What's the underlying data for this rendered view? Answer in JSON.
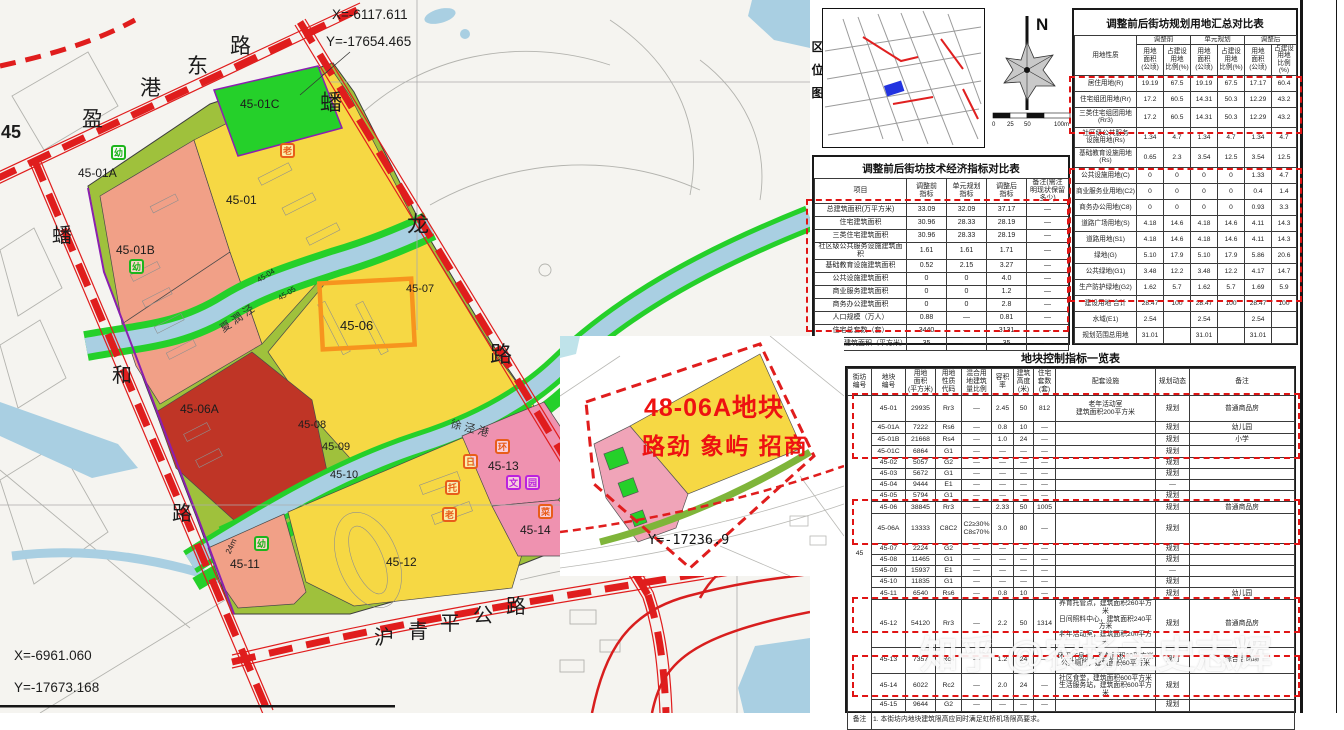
{
  "map": {
    "block_edge_label": "45",
    "coords": {
      "top_x": "X=-6117.611",
      "top_y": "Y=-17654.465",
      "bottom_x": "X=-6961.060",
      "bottom_y": "Y=-17673.168",
      "right_y": "Y=-17236.9"
    },
    "roads": {
      "yinggang": "盈港东路",
      "panhe": "蟠和路",
      "panlong": "蟠龙路",
      "huqingping": "沪青平公路"
    },
    "rivers": {
      "xiarun": "夏潤泾",
      "xujing": "徐泾港"
    },
    "width_label": "24m",
    "parcel_labels": {
      "p45_01": "45-01",
      "p45_01a": "45-01A",
      "p45_01b": "45-01B",
      "p45_01c": "45-01C",
      "p45_04": "45-04",
      "p45_05": "45-05",
      "p45_06": "45-06",
      "p45_06a": "45-06A",
      "p45_07": "45-07",
      "p45_08": "45-08",
      "p45_09": "45-09",
      "p45_10": "45-10",
      "p45_11": "45-11",
      "p45_12": "45-12",
      "p45_13": "45-13",
      "p45_14": "45-14"
    },
    "facility_icons": {
      "kindergarten": "幼",
      "elder": "老",
      "care": "托",
      "day": "日",
      "culture": "文",
      "garden": "园",
      "market": "菜",
      "sanitation": "环"
    },
    "colors": {
      "residential_yellow": "#f6d844",
      "salmon": "#f1a087",
      "dark_red": "#bf3526",
      "pink": "#ef92b0",
      "green": "#25d02a",
      "olive": "#9fc13c",
      "river_blue": "#a9cfe2",
      "road_red": "#e01d1d",
      "highlight_orange": "#f7941e"
    }
  },
  "inset": {
    "line1": "48-06A地块",
    "line2": "路劲 象屿 招商"
  },
  "location_map": {
    "title": "区位图"
  },
  "compass": {
    "north": "N",
    "scale_labels": [
      "0",
      "25",
      "50",
      "100m"
    ]
  },
  "side_label": "一般地区",
  "watermark": "知乎 @农场主史志辉",
  "tables": {
    "landuse": {
      "title": "调整前后街坊规划用地汇总对比表",
      "header_rows": [
        [
          {
            "t": "用地性质",
            "rs": 2
          },
          {
            "t": "调整前",
            "cs": 2
          },
          {
            "t": "单元规划",
            "cs": 2
          },
          {
            "t": "调整后",
            "cs": 2
          }
        ],
        [
          "用地\n面积\n(公顷)",
          "占建设\n用地\n比例(%)",
          "用地\n面积\n(公顷)",
          "占建设\n用地\n比例(%)",
          "用地\n面积\n(公顷)",
          "占建设\n用地\n比例(%)"
        ]
      ],
      "rows": [
        [
          "居住用地(R)",
          "19.19",
          "67.5",
          "19.19",
          "67.5",
          "17.17",
          "60.4"
        ],
        [
          "住宅组团用地(Rr)",
          "17.2",
          "60.5",
          "14.31",
          "50.3",
          "12.29",
          "43.2"
        ],
        [
          "三类住宅组团用地\n(Rr3)",
          "17.2",
          "60.5",
          "14.31",
          "50.3",
          "12.29",
          "43.2"
        ],
        [
          "社区级公共服务\n设施用地(Rs)",
          "1.34",
          "4.7",
          "1.34",
          "4.7",
          "1.34",
          "4.7"
        ],
        [
          "基础教育设施用地\n(Rs)",
          "0.65",
          "2.3",
          "3.54",
          "12.5",
          "3.54",
          "12.5"
        ],
        [
          "公共设施用地(C)",
          "0",
          "0",
          "0",
          "0",
          "1.33",
          "4.7"
        ],
        [
          "商业服务业用地(C2)",
          "0",
          "0",
          "0",
          "0",
          "0.4",
          "1.4"
        ],
        [
          "商务办公用地(C8)",
          "0",
          "0",
          "0",
          "0",
          "0.93",
          "3.3"
        ],
        [
          "道路广场用地(S)",
          "4.18",
          "14.6",
          "4.18",
          "14.6",
          "4.11",
          "14.3"
        ],
        [
          "道路用地(S1)",
          "4.18",
          "14.6",
          "4.18",
          "14.6",
          "4.11",
          "14.3"
        ],
        [
          "绿地(G)",
          "5.10",
          "17.9",
          "5.10",
          "17.9",
          "5.86",
          "20.6"
        ],
        [
          "公共绿地(G1)",
          "3.48",
          "12.2",
          "3.48",
          "12.2",
          "4.17",
          "14.7"
        ],
        [
          "生产防护绿地(G2)",
          "1.62",
          "5.7",
          "1.62",
          "5.7",
          "1.69",
          "5.9"
        ],
        [
          "建设用地  合计",
          "28.47",
          "100",
          "28.47",
          "100",
          "28.47",
          "100"
        ],
        [
          "水域(E1)",
          "2.54",
          "",
          "2.54",
          "",
          "2.54",
          ""
        ],
        [
          "规划范围总用地",
          "31.01",
          "",
          "31.01",
          "",
          "31.01",
          ""
        ]
      ]
    },
    "tech": {
      "title": "调整前后街坊技术经济指标对比表",
      "header_rows": [
        [
          "项目",
          "调整前\n指标",
          "单元规划\n指标",
          "调整后\n指标",
          "备注(需注\n明现状保留\n多少)"
        ]
      ],
      "rows": [
        [
          "总建筑面积(万平方米)",
          "33.09",
          "32.09",
          "37.17",
          "—"
        ],
        [
          "住宅建筑面积",
          "30.96",
          "28.33",
          "28.19",
          "—"
        ],
        [
          "三类住宅建筑面积",
          "30.96",
          "28.33",
          "28.19",
          "—"
        ],
        [
          "社区级公共服务设施建筑面积",
          "1.61",
          "1.61",
          "1.71",
          "—"
        ],
        [
          "基础教育设施建筑面积",
          "0.52",
          "2.15",
          "3.27",
          "—"
        ],
        [
          "公共设施建筑面积",
          "0",
          "0",
          "4.0",
          "—"
        ],
        [
          "商业服务建筑面积",
          "0",
          "0",
          "1.2",
          "—"
        ],
        [
          "商务办公建筑面积",
          "0",
          "0",
          "2.8",
          "—"
        ],
        [
          "人口规模（万人）",
          "0.88",
          "—",
          "0.81",
          "—"
        ],
        [
          "住宅总套数（套）",
          "3440",
          "—",
          "3131",
          "—"
        ],
        [
          "人均住宅建筑面积（平方米）",
          "35",
          "—",
          "35",
          "—"
        ]
      ]
    },
    "plots": {
      "title": "地块控制指标一览表",
      "header_rows": [
        [
          "街坊\n编号",
          "地块\n编号",
          "用地\n面积\n(平方米)",
          "用地\n性质\n代码",
          "混合用\n地建筑\n量比例",
          "容积率",
          "建筑\n高度\n(米)",
          "住宅\n套数\n(套)",
          "配套设施",
          "规划动态",
          "备注"
        ]
      ],
      "rows": [
        [
          {
            "t": "45",
            "rs": 19
          },
          "45-01",
          "29935",
          "Rr3",
          "—",
          "2.45",
          "50",
          "812",
          "老年活动室\n建筑面积200平方米",
          "规划",
          "普通商品房"
        ],
        [
          "45-01A",
          "7222",
          "Rs6",
          "—",
          "0.8",
          "10",
          "—",
          "",
          "规划",
          "幼儿园"
        ],
        [
          "45-01B",
          "21668",
          "Rs4",
          "—",
          "1.0",
          "24",
          "—",
          "",
          "规划",
          "小学"
        ],
        [
          "45-01C",
          "6864",
          "G1",
          "—",
          "—",
          "—",
          "—",
          "",
          "规划",
          ""
        ],
        [
          "45-02",
          "5057",
          "G2",
          "—",
          "—",
          "—",
          "—",
          "",
          "规划",
          ""
        ],
        [
          "45-03",
          "5672",
          "G1",
          "—",
          "—",
          "—",
          "—",
          "",
          "规划",
          ""
        ],
        [
          "45-04",
          "9444",
          "E1",
          "—",
          "—",
          "—",
          "—",
          "",
          "—",
          ""
        ],
        [
          "45-05",
          "5794",
          "G1",
          "—",
          "—",
          "—",
          "—",
          "",
          "规划",
          ""
        ],
        [
          "45-06",
          "38845",
          "Rr3",
          "—",
          "2.33",
          "50",
          "1005",
          "",
          "规划",
          "普通商品房"
        ],
        [
          "45-06A",
          "13333",
          "C8C2",
          "C2≥30%\nC8≤70%",
          "3.0",
          "80",
          "—",
          "",
          "规划",
          ""
        ],
        [
          "45-07",
          "2224",
          "G2",
          "—",
          "—",
          "—",
          "—",
          "",
          "规划",
          ""
        ],
        [
          "45-08",
          "11465",
          "G1",
          "—",
          "—",
          "—",
          "—",
          "",
          "规划",
          ""
        ],
        [
          "45-09",
          "15937",
          "E1",
          "—",
          "—",
          "—",
          "—",
          "",
          "—",
          ""
        ],
        [
          "45-10",
          "11835",
          "G1",
          "—",
          "—",
          "—",
          "—",
          "",
          "规划",
          ""
        ],
        [
          "45-11",
          "6540",
          "Rs6",
          "—",
          "0.8",
          "10",
          "—",
          "",
          "规划",
          "幼儿园"
        ],
        [
          "45-12",
          "54120",
          "Rr3",
          "—",
          "2.2",
          "50",
          "1314",
          "养育托管点，建筑面积260平方米\n日间照料中心，建筑面积240平方米\n老年活动室，建筑面积200平方米",
          "规划",
          "普通商品房"
        ],
        [
          "45-13",
          "7357",
          "Rc4",
          "—",
          "1.2",
          "24",
          "—",
          "环卫作息点，建筑面积60平方米\n公共厕所，建筑面积60平方米",
          "规划",
          "综合活动场"
        ],
        [
          "45-14",
          "6022",
          "Rc2",
          "—",
          "2.0",
          "24",
          "—",
          "社区食堂，建筑面积600平方米\n生活服务站，建筑面积600平方米",
          "规划",
          ""
        ],
        [
          "45-15",
          "9644",
          "G2",
          "—",
          "—",
          "—",
          "—",
          "",
          "规划",
          ""
        ],
        [
          {
            "t": "备注"
          },
          {
            "t": "1. 本街坊内地块建筑限高应同时满足虹桥机场限高要求。",
            "cs": 10,
            "al": "left"
          }
        ]
      ]
    }
  }
}
